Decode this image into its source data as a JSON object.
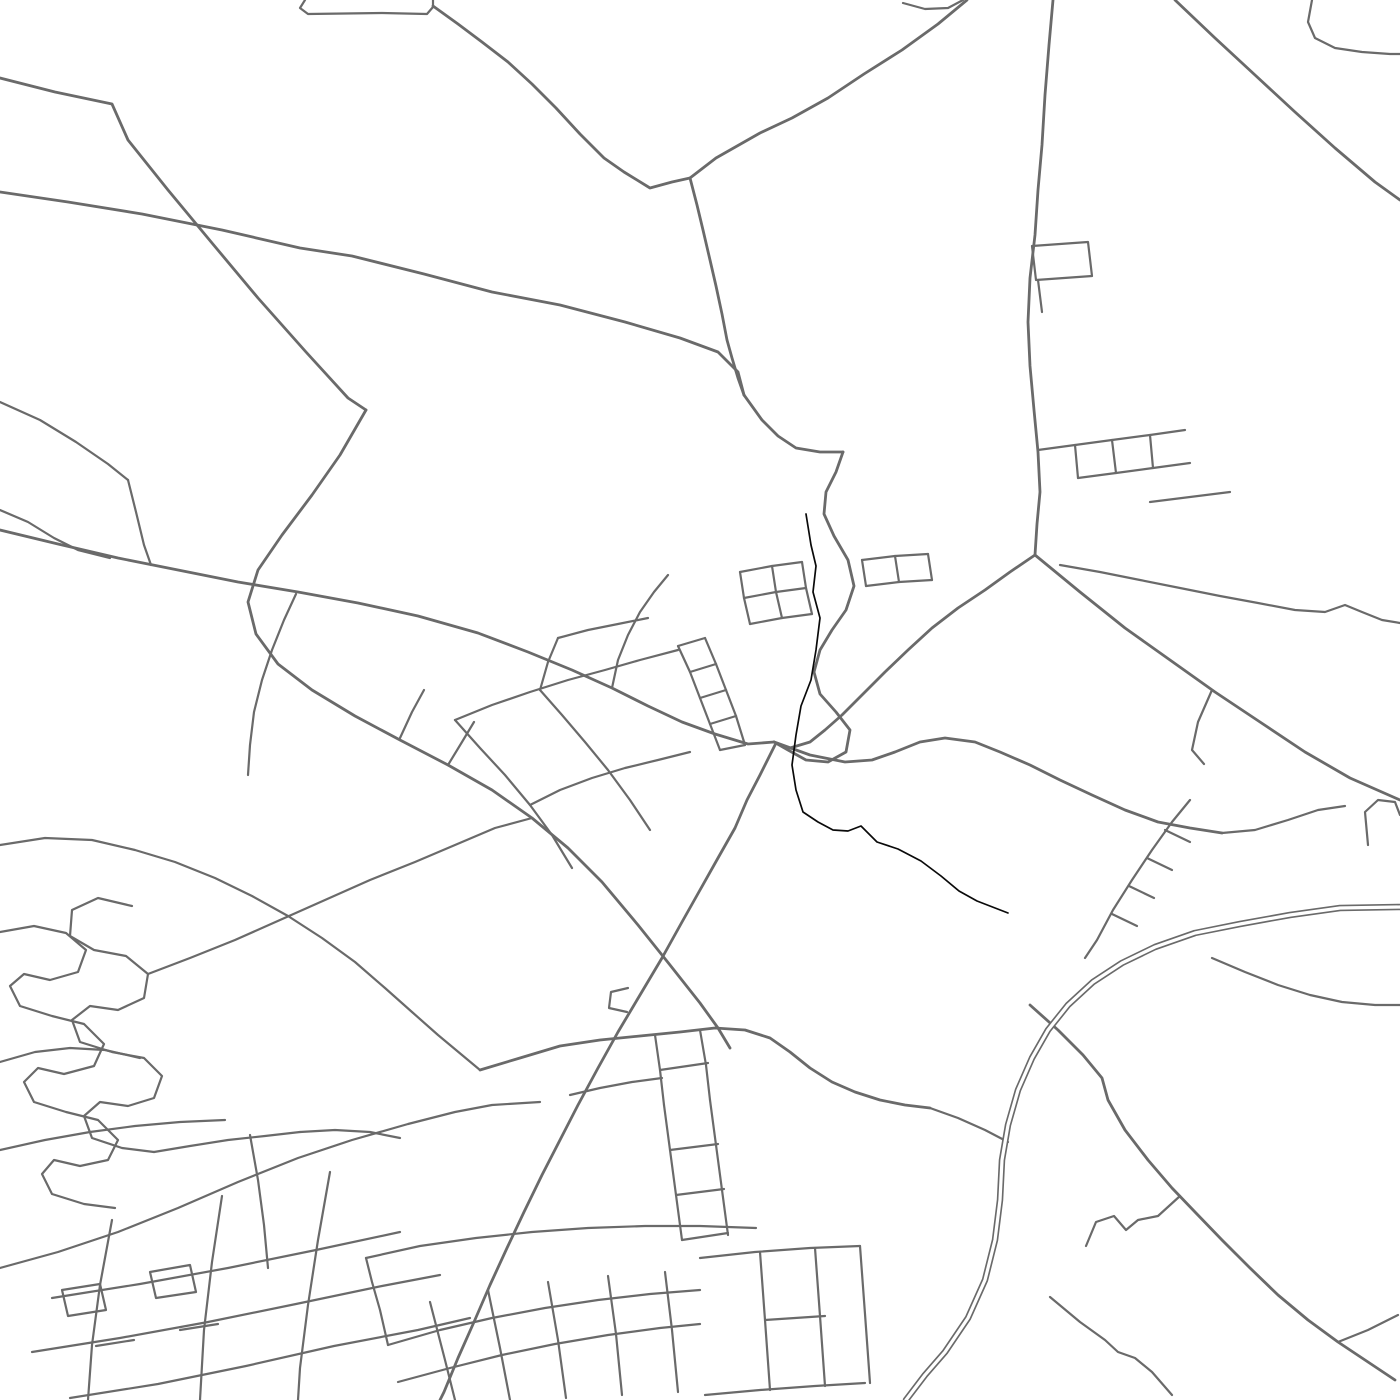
{
  "map": {
    "canvas": {
      "width": 1400,
      "height": 1400
    },
    "colors": {
      "background": "#ffffff",
      "road": "#6a6a6a",
      "stream": "#0a0a0a",
      "highway_casing": "#6a6a6a",
      "highway_inner": "#ffffff"
    },
    "style": {
      "road_width": 2.2,
      "major_road_width": 2.8,
      "stream_width": 1.7,
      "highway_casing_width": 6.5,
      "highway_inner_width": 3.2
    },
    "stream": {
      "pts": "806,514 811,545 816,566 813,592 820,618 816,650 811,680 801,706 796,735 792,765 796,790 803,812 818,822 833,830 848,831 861,826 877,842 898,849 921,861 941,876 959,891 977,901 1008,913"
    },
    "highway": {
      "pts": "1400,907 1340,908 1290,915 1240,924 1195,933 1155,947 1122,963 1093,982 1068,1005 1048,1030 1032,1058 1018,1090 1008,1125 1002,1160 1000,1200 995,1240 985,1280 968,1318 945,1352 925,1375 906,1400"
    },
    "roads": [
      {
        "w": 2.8,
        "pts": "0,78 55,92 112,104 128,140 168,190 212,243 258,298 306,352 348,398 366,410"
      },
      {
        "w": 2.8,
        "pts": "366,410 340,455 312,495 282,535 258,570 248,602 256,634 278,664 312,690 355,716 400,740 448,765 492,790 532,818 568,848 602,882 638,925 670,965 700,1003 718,1028 730,1048"
      },
      {
        "w": 2.8,
        "pts": "0,192 68,202 142,214 222,230 300,248 352,256 424,274 492,292 560,305 625,322 680,338 718,352 738,372 744,395"
      },
      {
        "pts": "305,0 300,8 308,14 382,13 427,14 433,7 433,0"
      },
      {
        "w": 2.8,
        "pts": "433,6 458,24 482,42 508,62 532,84 556,108 580,134 604,158 624,172 650,188 672,182 690,178"
      },
      {
        "w": 2.8,
        "pts": "967,0 938,24 902,50 864,74 828,98 792,118 760,133 716,158 690,178"
      },
      {
        "w": 2.8,
        "pts": "690,178 697,205 703,230 710,260 716,286 722,314 727,340 732,358 738,378 744,395"
      },
      {
        "w": 2.8,
        "pts": "744,395 762,420 778,436 796,448 820,452 843,452"
      },
      {
        "w": 2.8,
        "pts": "843,452 836,472 826,492 824,514 834,536 848,560 854,586 846,610 832,630 820,650 814,672 820,694 836,712 850,730 846,752 828,762 806,760 788,750 774,742"
      },
      {
        "w": 2.8,
        "pts": "0,530 58,544 118,558 178,570 238,582 298,592 358,603 418,616 478,633 528,652 572,670 612,688 648,706 682,722 715,734 748,744 774,742"
      },
      {
        "pts": "296,594 284,620 272,650 262,680 254,712 250,745 248,775"
      },
      {
        "pts": "0,402 40,420 76,442 108,464 128,480"
      },
      {
        "pts": "128,480 136,512 144,545 151,565"
      },
      {
        "pts": "0,510 28,522 54,538 78,550 110,558"
      },
      {
        "pts": "132,906 98,898 72,910 70,936 94,950 126,956 148,974 144,998 118,1010 90,1006 72,1020 80,1042 112,1052 144,1058 162,1076 154,1098 128,1106 100,1102 84,1116 92,1138 122,1148 154,1152"
      },
      {
        "pts": "0,932 34,926 66,933 86,950 78,972 50,980 24,974 10,986 20,1006 52,1016 84,1024 104,1044 94,1066 64,1074 38,1068 24,1082 34,1102 66,1112 98,1120 118,1140 108,1160 80,1166 54,1160 42,1174 52,1194 84,1204 115,1208"
      },
      {
        "pts": "148,974 190,958 235,940 280,920 325,900 370,880 415,862 455,845 495,828 532,818"
      },
      {
        "pts": "154,1152 190,1146 228,1140 265,1136 300,1132"
      },
      {
        "pts": "0,845 45,838 92,840 135,850 175,862 215,878 252,896 288,916 322,938 355,962 385,988 412,1012 438,1035 462,1055 480,1070"
      },
      {
        "pts": "0,1062 35,1052 70,1048 105,1050 140,1058"
      },
      {
        "pts": "0,1268 58,1252 118,1232 178,1208 238,1182 298,1158 352,1140 408,1124 455,1112 492,1105 540,1102"
      },
      {
        "pts": "112,1220 100,1285 92,1345 88,1400"
      },
      {
        "pts": "222,1196 212,1262 204,1330 200,1400"
      },
      {
        "pts": "330,1172 318,1240 308,1305 300,1368 298,1400"
      },
      {
        "pts": "52,1298 140,1284 228,1268 316,1250 400,1232"
      },
      {
        "pts": "32,1352 120,1338 208,1322 296,1304 382,1286 440,1275"
      },
      {
        "pts": "70,1398 158,1384 246,1366 334,1346 418,1330 470,1318"
      },
      {
        "pts": "62,1290 100,1284 106,1310 68,1316 62,1290"
      },
      {
        "pts": "150,1272 190,1265 196,1292 156,1298 150,1272"
      },
      {
        "pts": "96,1346 134,1340"
      },
      {
        "pts": "180,1330 218,1324"
      },
      {
        "pts": "388,1345 440,1330 492,1318 545,1308 598,1300 650,1294 700,1290"
      },
      {
        "pts": "398,1382 450,1368 502,1355 555,1344 608,1335 660,1328 700,1324"
      },
      {
        "pts": "430,1302 445,1360 455,1400"
      },
      {
        "pts": "488,1290 500,1348 510,1400"
      },
      {
        "pts": "548,1282 558,1340 566,1398"
      },
      {
        "pts": "608,1276 616,1334 622,1395"
      },
      {
        "pts": "665,1272 672,1330 678,1392"
      },
      {
        "pts": "388,1345 380,1310 372,1282 366,1258"
      },
      {
        "pts": "366,1258 420,1246 476,1238 532,1232 588,1228 645,1226 700,1226 756,1228"
      },
      {
        "w": 2.8,
        "pts": "775,745 760,775 747,800 735,828 718,858 700,890 682,922 662,958 640,995 618,1032 598,1068 578,1105 560,1140 542,1175 524,1212 507,1248 490,1285 474,1322 458,1358 444,1392 440,1400"
      },
      {
        "w": 2.8,
        "pts": "774,742 810,755 845,762 872,760 895,752 920,742 945,738 975,742 1000,752 1030,765 1060,780 1092,795 1125,810 1158,822 1190,828 1222,833"
      },
      {
        "pts": "1222,833 1255,830 1288,820 1318,810 1345,806"
      },
      {
        "pts": "1368,845 1365,812 1378,800 1395,802 1400,815"
      },
      {
        "pts": "1190,800 1172,822 1152,850 1132,880 1113,910 1097,940 1085,958"
      },
      {
        "pts": "1165,830 1190,842"
      },
      {
        "pts": "1147,858 1172,870"
      },
      {
        "pts": "1129,886 1154,898"
      },
      {
        "pts": "1112,914 1137,926"
      },
      {
        "w": 2.8,
        "pts": "1035,555 1080,592 1125,628 1170,660 1215,692 1260,722 1305,752 1350,778 1400,800"
      },
      {
        "pts": "1212,690 1198,722 1192,750 1204,764"
      },
      {
        "w": 2.8,
        "pts": "1053,0 1049,45 1045,95 1042,145 1038,190 1035,235 1030,278 1028,322 1030,366 1034,410 1038,452 1040,492 1037,524 1035,555"
      },
      {
        "w": 2.8,
        "pts": "1175,0 1215,38 1255,75 1295,112 1335,148 1375,182 1400,200"
      },
      {
        "pts": "1032,246 1088,242 1092,276 1036,280 1032,246"
      },
      {
        "pts": "1038,280 1042,312"
      },
      {
        "w": 2.8,
        "pts": "1035,555 1010,572 985,590 958,608 932,628 908,650 885,672 862,695 842,715 825,730 810,742 790,748 774,742"
      },
      {
        "pts": "1038,450 1075,445 1112,440 1150,435 1185,430"
      },
      {
        "pts": "1075,445 1078,478"
      },
      {
        "pts": "1112,440 1116,473"
      },
      {
        "pts": "1150,435 1153,468"
      },
      {
        "pts": "1078,478 1116,473 1153,468 1190,463"
      },
      {
        "pts": "1150,502 1190,497 1230,492"
      },
      {
        "pts": "705,638 716,664 726,690 736,716 745,745"
      },
      {
        "pts": "678,646 690,672 700,698 710,724 720,750"
      },
      {
        "pts": "705,638 678,646"
      },
      {
        "pts": "716,664 690,672"
      },
      {
        "pts": "726,690 700,698"
      },
      {
        "pts": "736,716 710,724"
      },
      {
        "pts": "745,745 720,750"
      },
      {
        "pts": "740,572 772,566 802,562"
      },
      {
        "pts": "744,598 776,592 806,588"
      },
      {
        "pts": "750,624 782,618 812,614"
      },
      {
        "pts": "740,572 744,598 750,624"
      },
      {
        "pts": "772,566 776,592 782,618"
      },
      {
        "pts": "802,562 806,588 812,614"
      },
      {
        "pts": "862,560 895,556 928,554"
      },
      {
        "pts": "866,586 899,582 932,580"
      },
      {
        "pts": "862,560 866,586"
      },
      {
        "pts": "895,556 899,582"
      },
      {
        "pts": "928,554 932,580"
      },
      {
        "pts": "540,690 562,715 585,742 608,770 630,800 650,830"
      },
      {
        "pts": "455,720 480,748 505,775 530,805 552,835 572,868"
      },
      {
        "pts": "455,720 492,705 530,692 568,680 605,670 640,660 678,650"
      },
      {
        "pts": "530,805 560,790 592,778 625,768 658,760 690,752"
      },
      {
        "pts": "400,738 412,712 424,690"
      },
      {
        "pts": "448,765 462,742 474,722"
      },
      {
        "pts": "628,988 611,992 609,1008 627,1012"
      },
      {
        "pts": "655,1035 660,1070 664,1105"
      },
      {
        "pts": "700,1030 706,1065 710,1100"
      },
      {
        "pts": "660,1070 708,1063"
      },
      {
        "pts": "570,1095 600,1088 632,1082 662,1078"
      },
      {
        "w": 2.8,
        "pts": "480,1070 520,1058 560,1046 600,1040 640,1036 680,1032 715,1028 745,1030 770,1038 790,1052 810,1068 832,1082 855,1092 880,1100 905,1105 930,1108"
      },
      {
        "pts": "930,1108 958,1118 985,1130 1008,1142"
      },
      {
        "w": 2.8,
        "pts": "1030,1005 1058,1030 1083,1055 1102,1078 1108,1100 1125,1130 1148,1160 1172,1188 1195,1212 1222,1240 1250,1268 1278,1295 1308,1320 1338,1342 1368,1362 1395,1380"
      },
      {
        "pts": "1338,1342 1368,1330 1398,1315"
      },
      {
        "pts": "1086,1246 1096,1222 1114,1216 1126,1230 1138,1220 1158,1216 1180,1196"
      },
      {
        "pts": "1050,1297 1080,1322 1105,1340 1118,1352 1135,1358 1152,1372 1172,1395"
      },
      {
        "pts": "1212,958 1245,972 1278,985 1310,995 1342,1002 1375,1005 1400,1005"
      },
      {
        "pts": "1060,565 1100,572 1140,580 1180,588 1220,596 1258,603 1295,610 1325,612 1345,605 1362,612 1382,620 1400,623"
      },
      {
        "pts": "1312,0 1308,22 1315,38 1335,48 1362,52 1390,54 1400,54"
      },
      {
        "pts": "903,3 925,9 948,8 963,0"
      },
      {
        "pts": "612,688 618,660 628,635 640,612 654,592 668,575"
      },
      {
        "pts": "540,690 548,662 558,638"
      },
      {
        "pts": "558,638 588,630 618,624 648,618"
      },
      {
        "pts": "300,1132 335,1130 370,1132 400,1138"
      },
      {
        "pts": "250,1135 258,1180 264,1225 268,1268"
      },
      {
        "pts": "0,1150 45,1140 90,1132 135,1126 180,1122 225,1120"
      },
      {
        "pts": "700,1258 755,1252 810,1248 860,1246"
      },
      {
        "pts": "705,1395 760,1390 815,1386 865,1383"
      },
      {
        "pts": "760,1252 765,1320 770,1390"
      },
      {
        "pts": "815,1248 820,1316 825,1386"
      },
      {
        "pts": "860,1246 865,1314 870,1383"
      },
      {
        "pts": "765,1320 825,1316"
      },
      {
        "pts": "664,1105 670,1150 676,1195 682,1240"
      },
      {
        "pts": "710,1100 716,1145 722,1190 728,1235"
      },
      {
        "pts": "670,1150 718,1144"
      },
      {
        "pts": "676,1195 724,1189"
      },
      {
        "pts": "682,1240 728,1233"
      }
    ]
  }
}
